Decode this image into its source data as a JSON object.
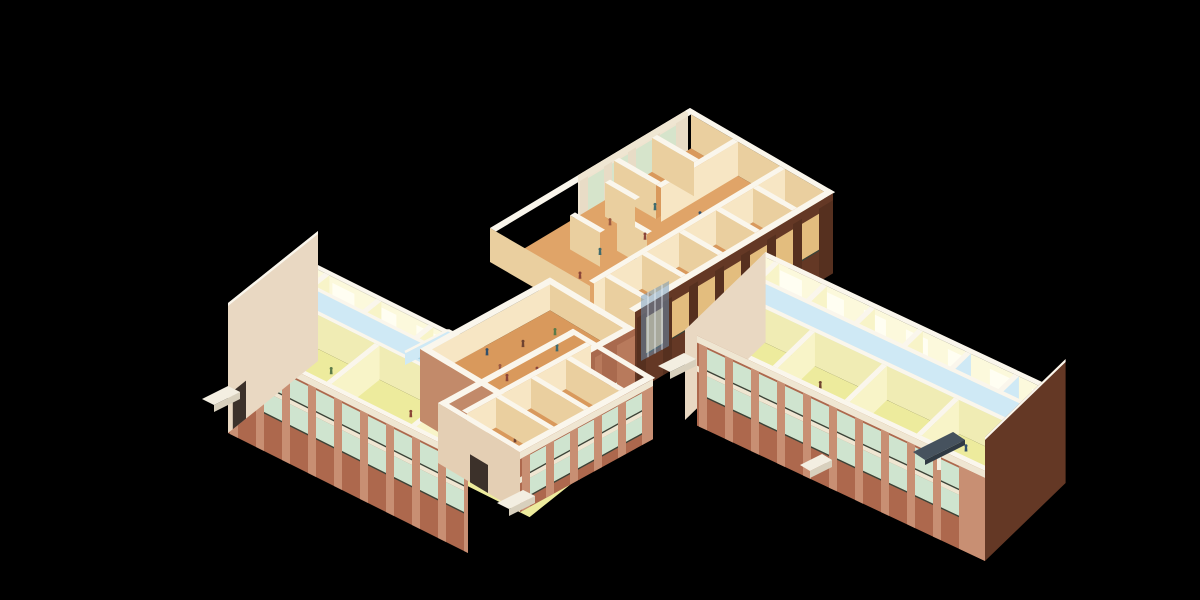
{
  "scene": {
    "width": 1200,
    "height": 600,
    "background": "#000000",
    "subject": "isometric-cutaway-floorplan-of-school-building"
  },
  "palette": {
    "topWhite": "#faf6ec",
    "slab": "#efe6d2",
    "floorYellow": "#edeb9d",
    "wallYellowLit": "#f8f4c8",
    "wallYellowShade": "#e8e4a4",
    "corridorWallYellow": "#f0ecb4",
    "backWallYellow": "#fcf9dc",
    "windowHint": "#fffef2",
    "floorBlue": "#a7d3e7",
    "wallBlueLit": "#cfe9f5",
    "wallBlueShade": "#8fc3da",
    "floorOrange": "#d9995c",
    "floorOrangeLight": "#e0a468",
    "wallCreamLit": "#f7e6c4",
    "wallCreamShade": "#eacf9f",
    "creamEnd": "#e4cfb4",
    "brickLit": "#ad684d",
    "brickPier": "#c88f73",
    "brickDark": "#643825",
    "brickDarkPier": "#56301f",
    "brickHall": "#a96a4e",
    "brickHallPier": "#b87a5c",
    "brickHallLit": "#c28a6a",
    "gableLight": "#e9d8c2",
    "door": "#3c312a",
    "windowGreen": "#cfe4cf",
    "windowWarm": "#e3bd7e",
    "frame": "#3a4338",
    "glass": "rgba(110,150,185,0.5)",
    "glassLine": "rgba(235,243,248,0.8)",
    "canopy": "#46525e",
    "canopyEdge": "#303a44",
    "porch": "#f3eee1",
    "porchShade": "#d8d0bd",
    "facadeCreamBase": "#efe4d0",
    "facadeCreamPier": "#e8dcc6",
    "facadeCreamWin": "#d6e4cb"
  },
  "people_colors": [
    "#8a4538",
    "#6f4330",
    "#3f6b6e",
    "#32506b",
    "#5a7a49",
    "#9c5a40"
  ],
  "building": {
    "wings": [
      {
        "name": "west-classroom-wing",
        "anchor": [
          228,
          337
        ],
        "u": [
          1,
          0.5
        ],
        "v": [
          0.6,
          -0.48
        ],
        "len": 300,
        "width": 150,
        "wallH": 34,
        "facade": {
          "a0": 0,
          "a1": 240,
          "h": 96
        },
        "gable": {
          "at": "start",
          "color": "gableLight",
          "door": true
        },
        "zones": {
          "front": [
            6,
            86
          ],
          "corridor": [
            86,
            116
          ],
          "back": [
            116,
            144
          ]
        },
        "frontParts": [
          10,
          95,
          180,
          262
        ],
        "backParts": [
          10,
          62,
          114,
          166,
          218,
          270
        ],
        "blueBackFrom": 218,
        "people": {
          "front": [
            [
              40,
              40
            ],
            [
              66,
              62
            ],
            [
              125,
              30
            ],
            [
              148,
              58
            ],
            [
              205,
              40
            ],
            [
              230,
              64
            ],
            [
              282,
              40
            ]
          ],
          "corridor": [
            [
              90,
              101
            ],
            [
              200,
              102
            ]
          ],
          "back": [
            [
              58,
              128
            ],
            [
              122,
              132
            ],
            [
              188,
              126
            ]
          ]
        }
      },
      {
        "name": "east-classroom-wing",
        "anchor": [
          685,
          330
        ],
        "u": [
          1,
          0.47
        ],
        "v": [
          0.62,
          -0.6
        ],
        "len": 300,
        "width": 130,
        "wallH": 34,
        "facade": {
          "a0": 12,
          "a1": 300,
          "h": 90
        },
        "gable": {
          "at": "end",
          "color": "brickDark",
          "door": false
        },
        "lightEndWall": true,
        "zones": {
          "front": [
            6,
            66
          ],
          "corridor": [
            66,
            94
          ],
          "back": [
            94,
            124
          ]
        },
        "frontParts": [
          12,
          84,
          156,
          228
        ],
        "backParts": [
          12,
          60,
          108,
          156,
          204,
          252
        ],
        "blueBackFrom": 204,
        "people": {
          "front": [
            [
              40,
              30
            ],
            [
              108,
              44
            ],
            [
              182,
              28
            ],
            [
              250,
              50
            ]
          ],
          "corridor": [
            [
              140,
              80
            ]
          ],
          "back": [
            [
              80,
              106
            ],
            [
              170,
              110
            ],
            [
              230,
              102
            ]
          ]
        }
      }
    ],
    "north_wing": {
      "name": "north-hall-wing",
      "anchor": [
        490,
        228
      ],
      "v": [
        1,
        -0.6
      ],
      "u": [
        1,
        0.58
      ],
      "len": 200,
      "width": 145,
      "wallH": 34,
      "westFacade": {
        "l0": 88,
        "l1": 198,
        "h": 80,
        "rows": [
          [
            9,
            44
          ]
        ]
      },
      "eastFacade": {
        "l0": 0,
        "l1": 198,
        "h": 80,
        "rows": [
          [
            12,
            48
          ]
        ]
      },
      "eastRoomsBand": [
        100,
        139
      ],
      "eastCrossWalls": [
        15,
        52,
        89,
        126,
        163
      ],
      "westRoomsBand": [
        6,
        48
      ],
      "westCrossWalls": [
        118,
        156
      ],
      "screens": [
        {
          "l": 50,
          "w1": 30,
          "w2": 60
        },
        {
          "l": 72,
          "w1": 55,
          "w2": 85
        },
        {
          "l": 95,
          "w1": 20,
          "w2": 50
        }
      ],
      "people": [
        [
          30,
          60
        ],
        [
          45,
          90
        ],
        [
          60,
          50
        ],
        [
          70,
          75
        ],
        [
          85,
          95
        ],
        [
          50,
          110
        ],
        [
          95,
          60
        ],
        [
          110,
          85
        ],
        [
          125,
          40
        ],
        [
          140,
          70
        ],
        [
          155,
          115
        ],
        [
          90,
          30
        ],
        [
          65,
          120
        ],
        [
          35,
          125
        ]
      ]
    },
    "hall": {
      "name": "central-elevated-hall",
      "anchorS": [
        505,
        400
      ],
      "v": [
        1,
        -0.55
      ],
      "mu": [
        -1,
        -0.6
      ],
      "lenV": 130,
      "widthU": 85,
      "parapet": 6,
      "faceH": 72,
      "floorDrop": 26,
      "windowRow": [
        44,
        64
      ],
      "people": [
        [
          30,
          25
        ],
        [
          45,
          50
        ],
        [
          62,
          30
        ],
        [
          78,
          60
        ],
        [
          92,
          40
        ],
        [
          52,
          70
        ],
        [
          105,
          55
        ],
        [
          66,
          15
        ],
        [
          40,
          38
        ]
      ]
    },
    "stub": {
      "name": "south-annex-wing",
      "anchorSW": [
        438,
        403
      ],
      "v": [
        1,
        -0.55
      ],
      "u": [
        1,
        0.6
      ],
      "lenV": 135,
      "widthU": 82,
      "wallH": 30,
      "floorDrop": 30,
      "facadeH": 60,
      "corridorBand": [
        6,
        18
      ],
      "roomsBand": [
        23,
        76
      ],
      "crossWalls": [
        35,
        70,
        105
      ],
      "facadeRows": [
        [
          8,
          25
        ],
        [
          31,
          48
        ]
      ],
      "people": [
        [
          32,
          45
        ],
        [
          72,
          58
        ],
        [
          106,
          38
        ]
      ]
    },
    "core": {
      "name": "central-core-corridors",
      "floors": [
        [
          [
            405,
            352
          ],
          [
            448,
            330
          ],
          [
            502,
            357
          ],
          [
            459,
            379
          ]
        ],
        [
          [
            448,
            384
          ],
          [
            494,
            361
          ],
          [
            534,
            381
          ],
          [
            488,
            404
          ]
        ]
      ],
      "wallRibbons": [
        [
          [
            405,
            352
          ],
          [
            448,
            330
          ]
        ],
        [
          [
            448,
            330
          ],
          [
            502,
            357
          ]
        ],
        [
          [
            432,
            368
          ],
          [
            474,
            347
          ]
        ],
        [
          [
            459,
            379
          ],
          [
            502,
            357
          ]
        ]
      ],
      "ribbonH": 13
    },
    "glass_link": {
      "name": "glazed-stair-link",
      "quad": [
        [
          641,
          296
        ],
        [
          669,
          281
        ],
        [
          669,
          346
        ],
        [
          641,
          361
        ]
      ]
    },
    "porches": [
      {
        "name": "west-entrance-porch",
        "top": [
          [
            202,
            399
          ],
          [
            228,
            386
          ],
          [
            240,
            392
          ],
          [
            214,
            405
          ]
        ]
      },
      {
        "name": "south-annex-porch",
        "top": [
          [
            497,
            503
          ],
          [
            523,
            490
          ],
          [
            535,
            496
          ],
          [
            509,
            509
          ]
        ]
      },
      {
        "name": "east-wing-west-porch",
        "top": [
          [
            658,
            366
          ],
          [
            684,
            353
          ],
          [
            696,
            359
          ],
          [
            670,
            372
          ]
        ]
      },
      {
        "name": "east-wing-mid-porch",
        "top": [
          [
            800,
            465
          ],
          [
            822,
            454
          ],
          [
            832,
            460
          ],
          [
            810,
            471
          ]
        ]
      }
    ],
    "canopy": {
      "name": "east-entrance-canopy",
      "top": [
        [
          913,
          452
        ],
        [
          953,
          432
        ],
        [
          965,
          440
        ],
        [
          925,
          460
        ]
      ],
      "skirtH": 5
    }
  }
}
